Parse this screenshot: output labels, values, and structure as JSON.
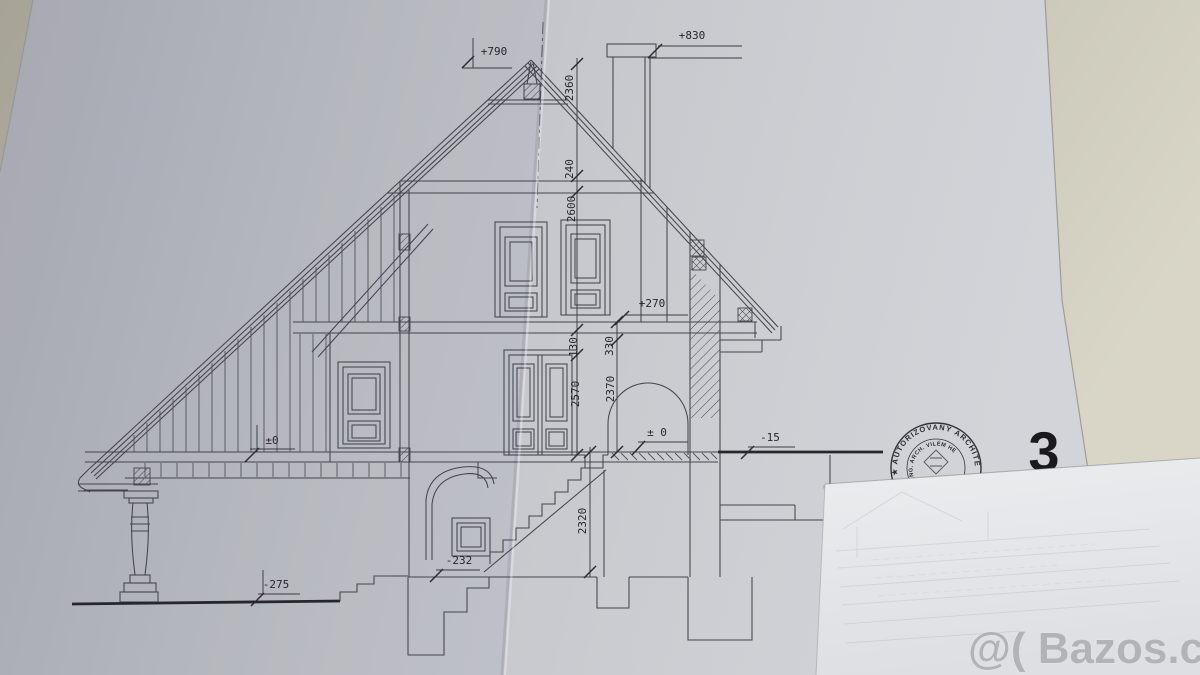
{
  "photo": {
    "sheet_number": "3",
    "watermark": "@( Bazos.cz",
    "wall_color": "#b3b0a2",
    "paper_color": "#c6c8cd",
    "ink_color": "#45464d"
  },
  "drawing": {
    "subject": "Hand-drafted architectural cross-section of a house with steep gable roof, porch, attic and basement",
    "level_marks": {
      "ridge": "+790",
      "chimney": "+830",
      "attic_floor": "+270",
      "ground_floor_porch": "±0",
      "ground_floor_arch": "± 0",
      "terrain_right": "-15",
      "basement_floor": "-232",
      "terrain_left": "-275"
    },
    "dimensions": {
      "ridge_to_collar": "2360",
      "collar_beam": "240",
      "attic_room_height": "2600",
      "sill": "130",
      "floor_package": "330",
      "ground_room_height": "2570",
      "ground_clear_height": "2370",
      "basement_room_height": "2320"
    },
    "stamp": {
      "ring_text": "★ AUTORIZOVANÝ ARCHITE",
      "inner_text": "ING. ARCH. VILÉM HE"
    }
  }
}
